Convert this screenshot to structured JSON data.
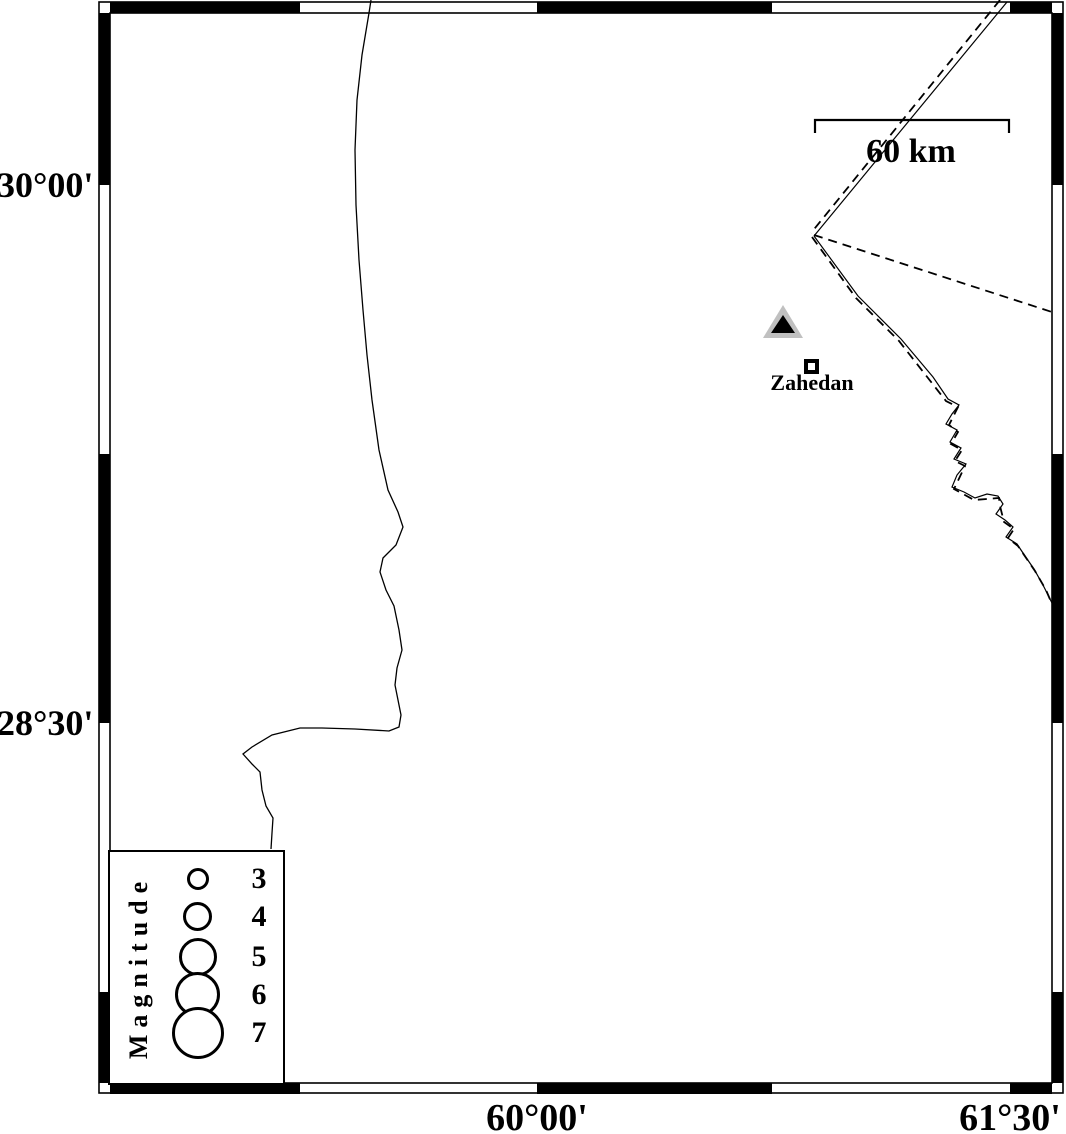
{
  "map": {
    "frame": {
      "lat_ticks": [
        {
          "label": "30°00'"
        },
        {
          "label": "28°30'"
        }
      ],
      "lon_ticks": [
        {
          "label": "60°00'"
        },
        {
          "label": "61°30'"
        }
      ]
    },
    "scale_bar": {
      "label": "60 km"
    },
    "city": {
      "label": "Zahedan"
    },
    "legend": {
      "title": "Magnitude",
      "entries": [
        {
          "label": "3"
        },
        {
          "label": "4"
        },
        {
          "label": "5"
        },
        {
          "label": "6"
        },
        {
          "label": "7"
        }
      ]
    },
    "colors": {
      "ink": "#000000",
      "background": "#ffffff",
      "station_fill": "#c0c0c0"
    }
  }
}
